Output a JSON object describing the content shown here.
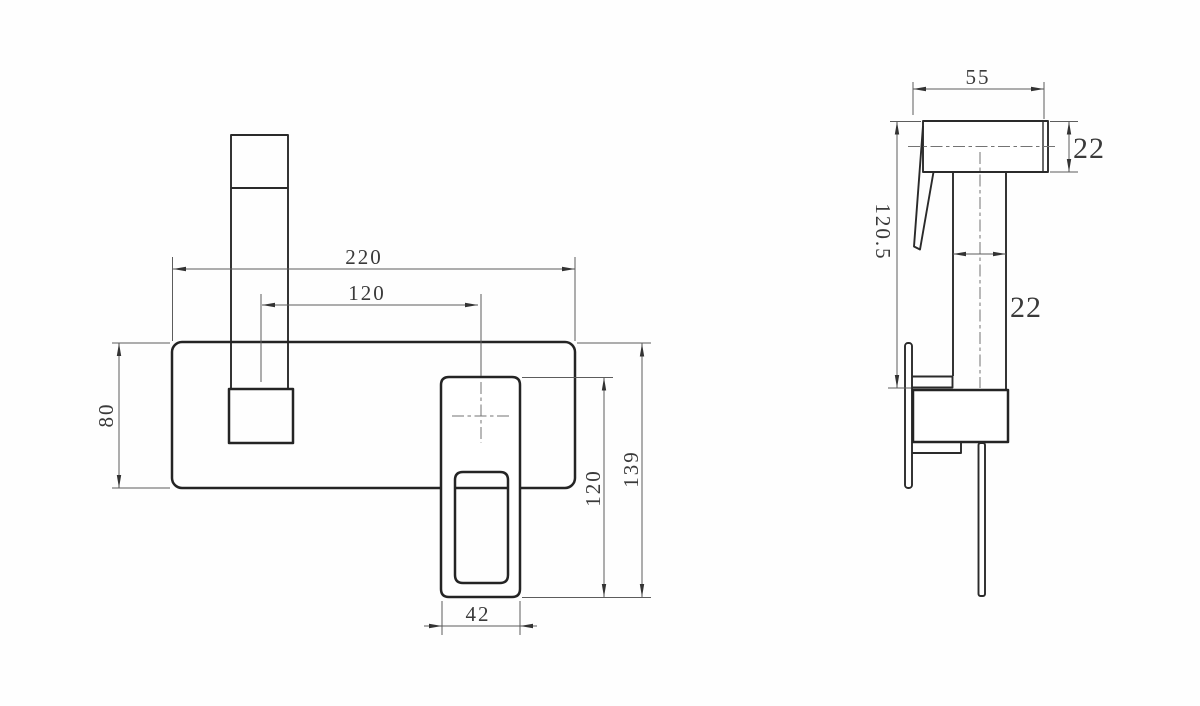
{
  "drawing": {
    "colors": {
      "background": "#fefefe",
      "object_line": "#242424",
      "dimension_line": "#5c5c5c",
      "text": "#3a3a3a"
    },
    "front_view": {
      "dims": {
        "plate_width": "220",
        "spout_to_handle": "120",
        "plate_height": "80",
        "handle_width": "42",
        "handle_height": "120",
        "overall_height": "139"
      }
    },
    "side_view": {
      "dims": {
        "head_length": "55",
        "head_height": "22",
        "body_height": "120.5",
        "tube_width": "22"
      }
    }
  }
}
